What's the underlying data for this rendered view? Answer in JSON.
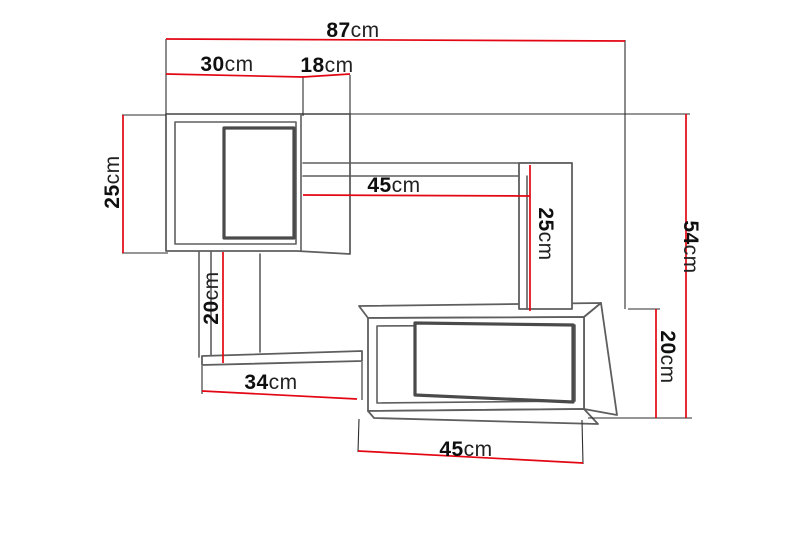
{
  "diagram": {
    "kind": "furniture-dimension-drawing",
    "subject": "wall shelf unit with two box shelves and connecting boards",
    "unit": "cm",
    "colors": {
      "dimension_line": "#e30613",
      "extension_line": "#2d2d2d",
      "furniture_outline": "#5e5e5e",
      "furniture_outline_heavy": "#4a4a4a",
      "label_text": "#0f0f0f",
      "background": "#ffffff"
    },
    "dimensions": {
      "total_width": {
        "num": "87",
        "unit": "cm",
        "value": 87,
        "orientation": "horizontal"
      },
      "cube_width": {
        "num": "30",
        "unit": "cm",
        "value": 30,
        "orientation": "horizontal"
      },
      "cube_depth": {
        "num": "18",
        "unit": "cm",
        "value": 18,
        "orientation": "horizontal"
      },
      "cube_height": {
        "num": "25",
        "unit": "cm",
        "value": 25,
        "orientation": "vertical-left"
      },
      "shelf_length": {
        "num": "45",
        "unit": "cm",
        "value": 45,
        "orientation": "horizontal"
      },
      "mid_panel_height": {
        "num": "25",
        "unit": "cm",
        "value": 25,
        "orientation": "vertical-right"
      },
      "total_height": {
        "num": "54",
        "unit": "cm",
        "value": 54,
        "orientation": "vertical-right"
      },
      "left_panel_height": {
        "num": "20",
        "unit": "cm",
        "value": 20,
        "orientation": "vertical-left"
      },
      "bottom_board_length": {
        "num": "34",
        "unit": "cm",
        "value": 34,
        "orientation": "horizontal"
      },
      "lower_box_height": {
        "num": "20",
        "unit": "cm",
        "value": 20,
        "orientation": "vertical-right"
      },
      "lower_box_width": {
        "num": "45",
        "unit": "cm",
        "value": 45,
        "orientation": "horizontal"
      }
    }
  }
}
